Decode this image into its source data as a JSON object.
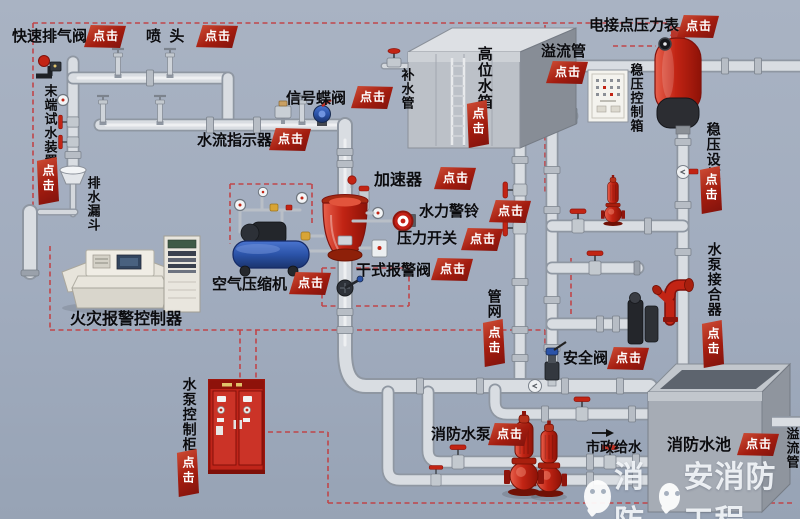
{
  "app": {
    "title": "消防干式自动喷水灭火系统交互图"
  },
  "badge_text": "点击",
  "colors": {
    "background": "#a1acbe",
    "pipe_body": "#d9dde2",
    "pipe_edge": "#8f97a2",
    "equipment_red": "#c22414",
    "badge_red": "#a31c0f",
    "dashed_line": "#c24043",
    "label_text": "#0b0b0e",
    "compressor_blue": "#2b53a8"
  },
  "callouts": [
    {
      "id": "quick-exhaust-valve",
      "text": "快速排气阀",
      "x": 12,
      "y": 29,
      "v": false,
      "fs": 15,
      "badge": {
        "x": 84,
        "y": 25,
        "v": false
      }
    },
    {
      "id": "sprinkler-head",
      "text": "喷  头",
      "x": 146,
      "y": 29,
      "v": false,
      "fs": 15,
      "badge": {
        "x": 196,
        "y": 25,
        "v": false
      }
    },
    {
      "id": "end-test-device",
      "text": "末端试水装置",
      "x": 42,
      "y": 84,
      "v": true,
      "fs": 13,
      "badge": {
        "x": 36,
        "y": 157,
        "v": true
      }
    },
    {
      "id": "drain-funnel",
      "text": "排水漏斗",
      "x": 85,
      "y": 176,
      "v": true,
      "fs": 13,
      "badge": null
    },
    {
      "id": "signal-butterfly-valve",
      "text": "信号蝶阀",
      "x": 286,
      "y": 91,
      "v": false,
      "fs": 15,
      "badge": {
        "x": 351,
        "y": 86,
        "v": false
      }
    },
    {
      "id": "water-flow-indicator",
      "text": "水流指示器",
      "x": 197,
      "y": 133,
      "v": false,
      "fs": 15,
      "badge": {
        "x": 269,
        "y": 128,
        "v": false
      }
    },
    {
      "id": "makeup-water-pipe",
      "text": "补水管",
      "x": 399,
      "y": 68,
      "v": true,
      "fs": 13,
      "badge": null
    },
    {
      "id": "high-level-tank",
      "text": "高位水箱",
      "x": 475,
      "y": 46,
      "v": true,
      "fs": 15,
      "badge": {
        "x": 466,
        "y": 100,
        "v": true
      }
    },
    {
      "id": "overflow-pipe-top",
      "text": "溢流管",
      "x": 541,
      "y": 44,
      "v": false,
      "fs": 15,
      "badge": {
        "x": 546,
        "y": 61,
        "v": false
      }
    },
    {
      "id": "electric-contact-pressure-gauge",
      "text": "电接点压力表",
      "x": 589,
      "y": 18,
      "v": false,
      "fs": 15,
      "badge": {
        "x": 677,
        "y": 15,
        "v": false
      }
    },
    {
      "id": "pressure-control-box",
      "text": "稳压控制箱",
      "x": 628,
      "y": 63,
      "v": true,
      "fs": 13,
      "badge": null
    },
    {
      "id": "pressure-stabilizing-facility",
      "text": "稳压设施",
      "x": 705,
      "y": 122,
      "v": true,
      "fs": 14,
      "badge": {
        "x": 699,
        "y": 166,
        "v": true
      }
    },
    {
      "id": "accelerator",
      "text": "加速器",
      "x": 374,
      "y": 172,
      "v": false,
      "fs": 16,
      "badge": {
        "x": 434,
        "y": 167,
        "v": false
      }
    },
    {
      "id": "hydraulic-alarm-bell",
      "text": "水力警铃",
      "x": 419,
      "y": 204,
      "v": false,
      "fs": 15,
      "badge": {
        "x": 489,
        "y": 200,
        "v": false
      }
    },
    {
      "id": "pressure-switch",
      "text": "压力开关",
      "x": 397,
      "y": 231,
      "v": false,
      "fs": 15,
      "badge": {
        "x": 461,
        "y": 228,
        "v": false
      }
    },
    {
      "id": "dry-alarm-valve",
      "text": "干式报警阀",
      "x": 356,
      "y": 263,
      "v": false,
      "fs": 15,
      "badge": {
        "x": 431,
        "y": 258,
        "v": false
      }
    },
    {
      "id": "air-compressor",
      "text": "空气压缩机",
      "x": 212,
      "y": 277,
      "v": false,
      "fs": 15,
      "badge": {
        "x": 289,
        "y": 272,
        "v": false
      }
    },
    {
      "id": "fire-alarm-controller",
      "text": "火灾报警控制器",
      "x": 70,
      "y": 311,
      "v": false,
      "fs": 16,
      "badge": null
    },
    {
      "id": "pump-control-cabinet",
      "text": "水泵控制柜",
      "x": 181,
      "y": 377,
      "v": true,
      "fs": 14,
      "badge": {
        "x": 176,
        "y": 449,
        "v": true
      }
    },
    {
      "id": "pipe-network",
      "text": "管网",
      "x": 486,
      "y": 289,
      "v": true,
      "fs": 14,
      "badge": {
        "x": 482,
        "y": 319,
        "v": true
      }
    },
    {
      "id": "pump-adapter",
      "text": "水泵接合器",
      "x": 706,
      "y": 242,
      "v": true,
      "fs": 14,
      "badge": {
        "x": 701,
        "y": 320,
        "v": true
      }
    },
    {
      "id": "safety-valve",
      "text": "安全阀",
      "x": 563,
      "y": 351,
      "v": false,
      "fs": 15,
      "badge": {
        "x": 607,
        "y": 347,
        "v": false
      }
    },
    {
      "id": "fire-pump",
      "text": "消防水泵",
      "x": 431,
      "y": 427,
      "v": false,
      "fs": 15,
      "badge": {
        "x": 488,
        "y": 423,
        "v": false
      }
    },
    {
      "id": "municipal-water-supply",
      "text": "市政给水",
      "x": 586,
      "y": 440,
      "v": false,
      "fs": 14,
      "badge": null
    },
    {
      "id": "fire-water-pool",
      "text": "消防水池",
      "x": 667,
      "y": 437,
      "v": false,
      "fs": 16,
      "badge": {
        "x": 737,
        "y": 433,
        "v": false
      }
    },
    {
      "id": "overflow-pipe-right",
      "text": "溢流管",
      "x": 784,
      "y": 427,
      "v": true,
      "fs": 13,
      "badge": null
    }
  ],
  "watermark": {
    "part1": "消防",
    "part2": "安消防工程"
  }
}
